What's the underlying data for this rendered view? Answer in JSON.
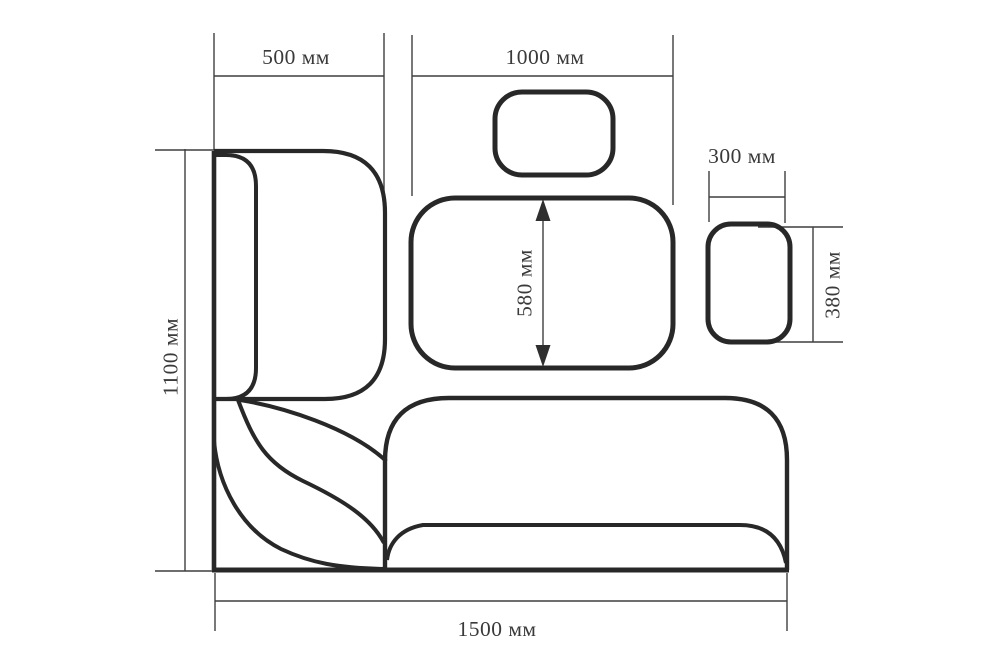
{
  "page": {
    "background": "#ffffff"
  },
  "drawing": {
    "kind": "corner-sofa-dimension-diagram",
    "unit": "мм",
    "colors": {
      "outline": "#282828",
      "dimension_lines": "#3f3f3f",
      "text": "#3a3a3a"
    },
    "dimensions": {
      "backrest_section_width": {
        "value": 500,
        "label": "500 мм"
      },
      "back_cushion_width": {
        "value": 1000,
        "label": "1000 мм"
      },
      "back_cushion_height": {
        "value": 580,
        "label": "580 мм"
      },
      "side_cushion_width": {
        "value": 300,
        "label": "300 мм"
      },
      "side_cushion_height": {
        "value": 380,
        "label": "380 мм"
      },
      "overall_height": {
        "value": 1100,
        "label": "1100 мм"
      },
      "overall_length": {
        "value": 1500,
        "label": "1500 мм"
      }
    }
  }
}
